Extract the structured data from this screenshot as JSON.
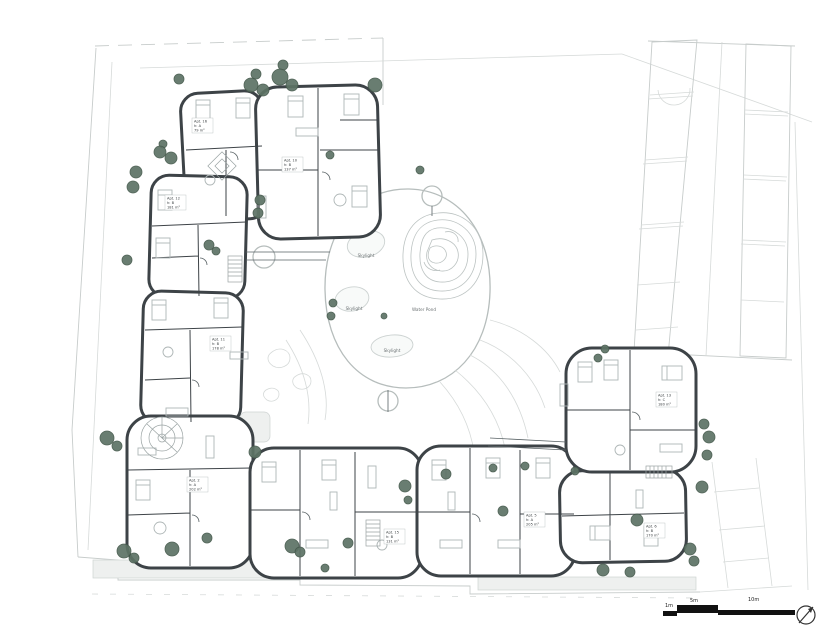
{
  "drawing": {
    "type": "residential ground floor site plan"
  },
  "courtyard": {
    "skylight_labels": [
      "Skylight",
      "Skylight",
      "Skylight"
    ],
    "water_pond_label": "Water Pond"
  },
  "apartments": [
    {
      "id": "Apt. 16",
      "floor": "h: A",
      "area": "79 m²"
    },
    {
      "id": "Apt. 10",
      "floor": "h: B",
      "area": "137 m²"
    },
    {
      "id": "Apt. 12",
      "floor": "h: B",
      "area": "181 m²"
    },
    {
      "id": "Apt. 11",
      "floor": "h: B",
      "area": "178 m²"
    },
    {
      "id": "Apt. 2",
      "floor": "h: A",
      "area": "202 m²"
    },
    {
      "id": "Apt. 15",
      "floor": "h: B",
      "area": "131 m²"
    },
    {
      "id": "Apt. 5",
      "floor": "h: A",
      "area": "205 m²"
    },
    {
      "id": "Apt. 6",
      "floor": "h: B",
      "area": "170 m²"
    },
    {
      "id": "Apt. 13",
      "floor": "h: C",
      "area": "180 m²"
    }
  ],
  "scale_bar": {
    "labels": [
      "1m",
      "5m",
      "10m"
    ]
  },
  "colors": {
    "wall": "#3d4347",
    "detail": "#aeb6b6",
    "site_line": "#c7cccb",
    "tree": "#5d7365",
    "tree_outline": "#44584b"
  },
  "trees": [
    [
      179,
      79,
      5
    ],
    [
      256,
      74,
      5
    ],
    [
      251,
      85,
      7
    ],
    [
      263,
      90,
      6
    ],
    [
      283,
      65,
      5
    ],
    [
      280,
      77,
      8
    ],
    [
      292,
      85,
      6
    ],
    [
      375,
      85,
      7
    ],
    [
      163,
      144,
      4
    ],
    [
      160,
      152,
      6
    ],
    [
      171,
      158,
      6
    ],
    [
      136,
      172,
      6
    ],
    [
      133,
      187,
      6
    ],
    [
      127,
      260,
      5
    ],
    [
      209,
      245,
      5
    ],
    [
      216,
      251,
      4
    ],
    [
      260,
      200,
      5
    ],
    [
      258,
      213,
      5
    ],
    [
      333,
      303,
      4
    ],
    [
      331,
      316,
      4
    ],
    [
      384,
      316,
      3
    ],
    [
      330,
      155,
      4
    ],
    [
      420,
      170,
      4
    ],
    [
      107,
      438,
      7
    ],
    [
      117,
      446,
      5
    ],
    [
      124,
      551,
      7
    ],
    [
      134,
      558,
      5
    ],
    [
      172,
      549,
      7
    ],
    [
      207,
      538,
      5
    ],
    [
      255,
      452,
      6
    ],
    [
      292,
      546,
      7
    ],
    [
      300,
      552,
      5
    ],
    [
      405,
      486,
      6
    ],
    [
      408,
      500,
      4
    ],
    [
      446,
      474,
      5
    ],
    [
      493,
      468,
      4
    ],
    [
      503,
      511,
      5
    ],
    [
      525,
      466,
      4
    ],
    [
      348,
      543,
      5
    ],
    [
      325,
      568,
      4
    ],
    [
      575,
      471,
      4
    ],
    [
      637,
      520,
      6
    ],
    [
      603,
      570,
      6
    ],
    [
      630,
      572,
      5
    ],
    [
      690,
      549,
      6
    ],
    [
      694,
      561,
      5
    ],
    [
      702,
      487,
      6
    ],
    [
      605,
      349,
      4
    ],
    [
      598,
      358,
      4
    ],
    [
      704,
      424,
      5
    ],
    [
      709,
      437,
      6
    ],
    [
      707,
      455,
      5
    ]
  ]
}
